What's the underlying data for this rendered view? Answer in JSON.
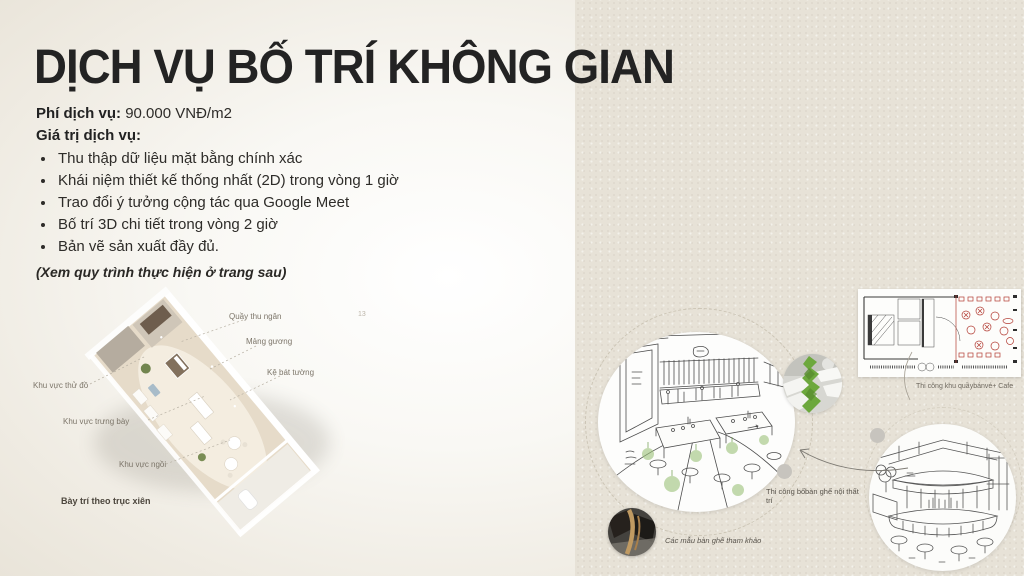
{
  "page": {
    "title": "DỊCH VỤ BỐ TRÍ KHÔNG GIAN",
    "page_number": "13"
  },
  "service": {
    "fee_label": "Phí dịch vụ:",
    "fee_value": "90.000 VNĐ/m2",
    "value_label": "Giá trị dịch vụ:",
    "bullets": [
      "Thu thập dữ liệu mặt bằng chính xác",
      "Khái niệm thiết kế thống nhất (2D) trong vòng 1 giờ",
      "Trao đổi ý tưởng cộng tác qua Google Meet",
      "Bố trí 3D chi tiết trong vòng 2 giờ",
      "Bản vẽ sản xuất đầy đủ."
    ],
    "note": "(Xem quy trình thực hiện ở trang sau)"
  },
  "floorplan": {
    "labels": {
      "cashier": "Quầy thu ngân",
      "mirror": "Mảng gương",
      "wall_shelf": "Kệ bát tường",
      "fitting": "Khu vực thử đồ",
      "display": "Khu vực trưng bày",
      "seating": "Khu vực ngồi"
    },
    "caption": "Bày trí theo trục xiên"
  },
  "right": {
    "plan_caption": "Thi công khu quầybánvé+ Cafe",
    "construction_label": "Thi công bố trí",
    "furniture_label": "bàn ghế nội thất",
    "reference_caption": "Các mẫu bàn ghế tham khảo"
  },
  "colors": {
    "accent_green": "#6da83d",
    "plan_red": "#b23b32",
    "paper": "#e7e2d7",
    "text": "#2b2b2b"
  }
}
